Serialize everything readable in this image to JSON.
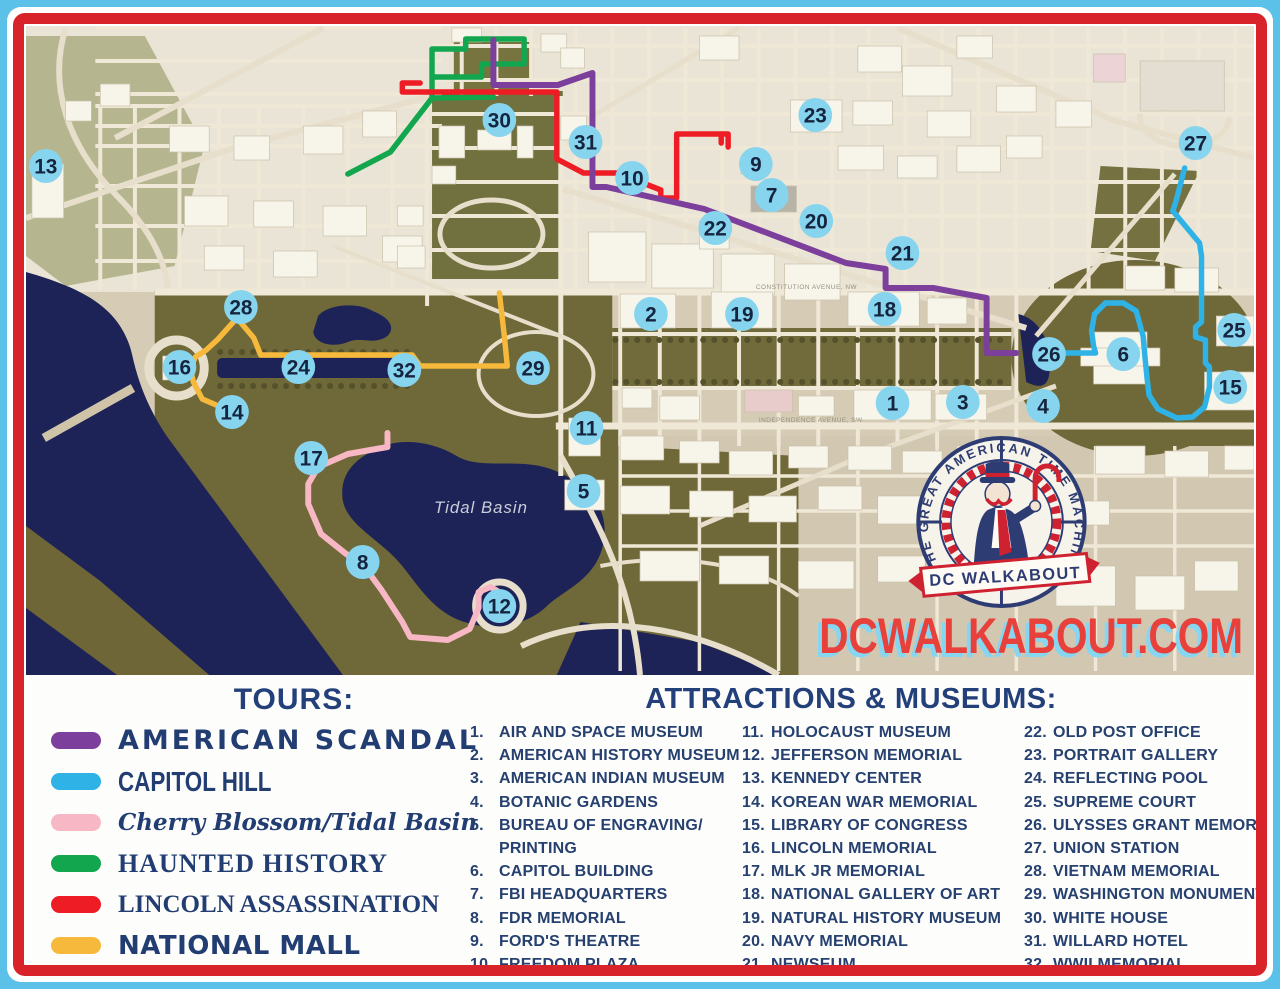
{
  "page": {
    "title": "DC Walkabout Tours Map"
  },
  "map": {
    "website": "DCWALKABOUT.COM",
    "website_color": "#e8403a",
    "website_shadow_color": "#86d6f2",
    "logo": {
      "ring_text": "THE GREAT AMERICAN TIME MACHINE",
      "banner_text": "DC WALKABOUT"
    },
    "labels": {
      "tidal_basin": "Tidal Basin",
      "constitution_ave": "CONSTITUTION AVENUE, NW",
      "independence_ave": "INDEPENDENCE AVENUE, SW"
    },
    "marker_style": {
      "fill": "#87d4ef",
      "text": "#16253f"
    },
    "markers": [
      {
        "number": "1",
        "x": 895,
        "y": 397
      },
      {
        "number": "2",
        "x": 651,
        "y": 308
      },
      {
        "number": "3",
        "x": 966,
        "y": 396
      },
      {
        "number": "4",
        "x": 1047,
        "y": 400
      },
      {
        "number": "5",
        "x": 583,
        "y": 485
      },
      {
        "number": "6",
        "x": 1128,
        "y": 348
      },
      {
        "number": "7",
        "x": 773,
        "y": 189
      },
      {
        "number": "8",
        "x": 360,
        "y": 556
      },
      {
        "number": "9",
        "x": 757,
        "y": 158
      },
      {
        "number": "10",
        "x": 632,
        "y": 172
      },
      {
        "number": "11",
        "x": 586,
        "y": 422
      },
      {
        "number": "12",
        "x": 498,
        "y": 600
      },
      {
        "number": "13",
        "x": 40,
        "y": 160
      },
      {
        "number": "14",
        "x": 228,
        "y": 406
      },
      {
        "number": "15",
        "x": 1236,
        "y": 381
      },
      {
        "number": "16",
        "x": 175,
        "y": 361
      },
      {
        "number": "17",
        "x": 308,
        "y": 452
      },
      {
        "number": "18",
        "x": 887,
        "y": 303
      },
      {
        "number": "19",
        "x": 743,
        "y": 308
      },
      {
        "number": "20",
        "x": 818,
        "y": 215
      },
      {
        "number": "21",
        "x": 905,
        "y": 247
      },
      {
        "number": "22",
        "x": 716,
        "y": 222
      },
      {
        "number": "23",
        "x": 817,
        "y": 109
      },
      {
        "number": "24",
        "x": 295,
        "y": 361
      },
      {
        "number": "25",
        "x": 1240,
        "y": 324
      },
      {
        "number": "26",
        "x": 1053,
        "y": 348
      },
      {
        "number": "27",
        "x": 1201,
        "y": 137
      },
      {
        "number": "28",
        "x": 237,
        "y": 301
      },
      {
        "number": "29",
        "x": 532,
        "y": 362
      },
      {
        "number": "30",
        "x": 498,
        "y": 114
      },
      {
        "number": "31",
        "x": 585,
        "y": 136
      },
      {
        "number": "32",
        "x": 402,
        "y": 364
      }
    ]
  },
  "tours": {
    "heading": "TOURS:",
    "items": [
      {
        "key": "american-scandal",
        "label": "AMERICAN SCANDAL",
        "color": "#7c3f9b",
        "style": "scandal"
      },
      {
        "key": "capitol-hill",
        "label": "CAPITOL HILL",
        "color": "#2fb3e6",
        "style": "capitol"
      },
      {
        "key": "cherry-blossom",
        "label": "Cherry Blossom/Tidal Basin",
        "color": "#f8b7c4",
        "style": "script"
      },
      {
        "key": "haunted-history",
        "label": "HAUNTED HISTORY",
        "color": "#12a64e",
        "style": "serif-sc"
      },
      {
        "key": "lincoln-assassination",
        "label": "LINCOLN ASSASSINATION",
        "color": "#ee1c25",
        "style": "serif"
      },
      {
        "key": "national-mall",
        "label": "NATIONAL MALL",
        "color": "#f7b93c",
        "style": "rounded"
      }
    ]
  },
  "attractions": {
    "heading": "ATTRACTIONS & MUSEUMS:",
    "columns": [
      {
        "items": [
          {
            "num": "1.",
            "label": "AIR AND SPACE MUSEUM"
          },
          {
            "num": "2.",
            "label": "AMERICAN HISTORY MUSEUM"
          },
          {
            "num": "3.",
            "label": "AMERICAN INDIAN MUSEUM"
          },
          {
            "num": "4.",
            "label": "BOTANIC GARDENS"
          },
          {
            "num": "5.",
            "label": "BUREAU OF ENGRAVING/ PRINTING"
          },
          {
            "num": "6.",
            "label": "CAPITOL BUILDING"
          },
          {
            "num": "7.",
            "label": "FBI HEADQUARTERS"
          },
          {
            "num": "8.",
            "label": "FDR MEMORIAL"
          },
          {
            "num": "9.",
            "label": "FORD'S THEATRE"
          },
          {
            "num": "10.",
            "label": "FREEDOM PLAZA"
          }
        ]
      },
      {
        "items": [
          {
            "num": "11.",
            "label": "HOLOCAUST MUSEUM"
          },
          {
            "num": "12.",
            "label": "JEFFERSON MEMORIAL"
          },
          {
            "num": "13.",
            "label": "KENNEDY CENTER"
          },
          {
            "num": "14.",
            "label": "KOREAN WAR MEMORIAL"
          },
          {
            "num": "15.",
            "label": "LIBRARY OF CONGRESS"
          },
          {
            "num": "16.",
            "label": "LINCOLN MEMORIAL"
          },
          {
            "num": "17.",
            "label": "MLK JR MEMORIAL"
          },
          {
            "num": "18.",
            "label": "NATIONAL GALLERY OF ART"
          },
          {
            "num": "19.",
            "label": "NATURAL HISTORY MUSEUM"
          },
          {
            "num": "20.",
            "label": "NAVY MEMORIAL"
          },
          {
            "num": "21.",
            "label": "NEWSEUM"
          }
        ]
      },
      {
        "items": [
          {
            "num": "22.",
            "label": "OLD POST OFFICE"
          },
          {
            "num": "23.",
            "label": "PORTRAIT GALLERY"
          },
          {
            "num": "24.",
            "label": "REFLECTING POOL"
          },
          {
            "num": "25.",
            "label": "SUPREME COURT"
          },
          {
            "num": "26.",
            "label": "ULYSSES GRANT MEMORIAL"
          },
          {
            "num": "27.",
            "label": "UNION STATION"
          },
          {
            "num": "28.",
            "label": "VIETNAM MEMORIAL"
          },
          {
            "num": "29.",
            "label": "WASHINGTON MONUMENT"
          },
          {
            "num": "30.",
            "label": "WHITE HOUSE"
          },
          {
            "num": "31.",
            "label": "WILLARD HOTEL"
          },
          {
            "num": "32.",
            "label": "WWII MEMORIAL"
          }
        ]
      }
    ]
  }
}
